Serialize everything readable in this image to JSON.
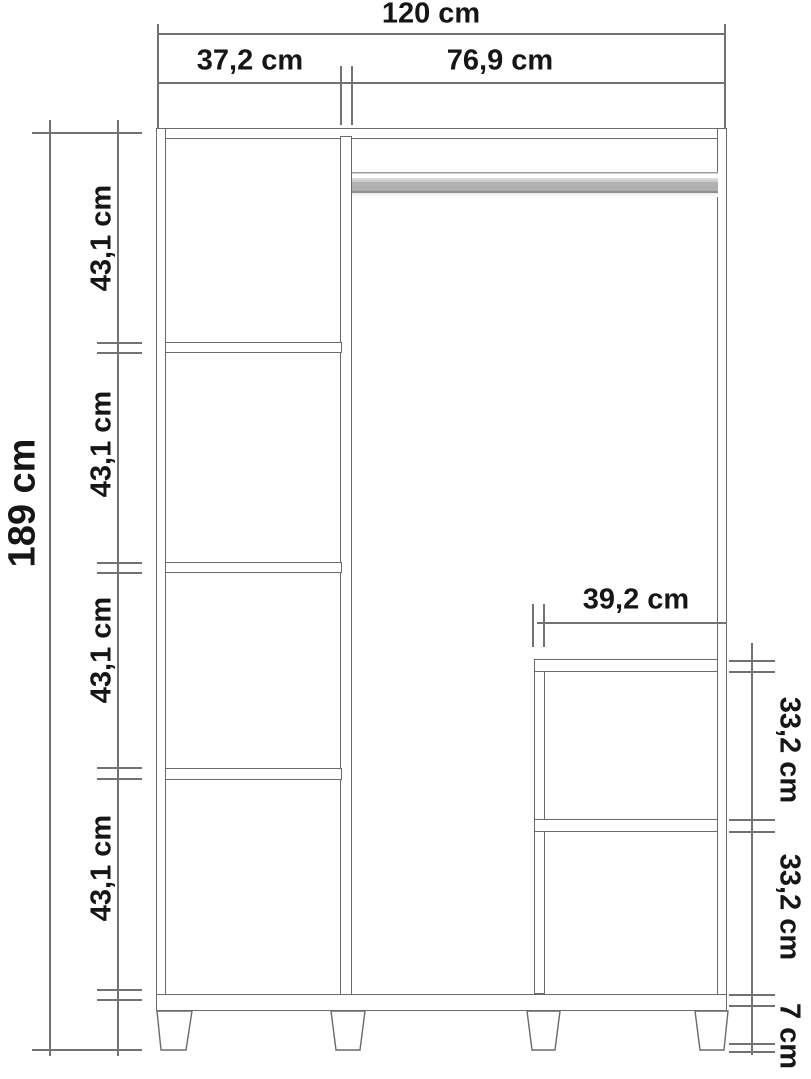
{
  "colors": {
    "background": "#ffffff",
    "structure_line": "#6a6a6a",
    "dimension_line": "#727272",
    "text": "#161616",
    "rail_gray": "#b2b2b2"
  },
  "labels": {
    "total_width": "120 cm",
    "left_section_width": "37,2 cm",
    "right_section_width": "76,9 cm",
    "total_height": "189 cm",
    "left_gap_1": "43,1 cm",
    "left_gap_2": "43,1 cm",
    "left_gap_3": "43,1 cm",
    "left_gap_4": "43,1 cm",
    "compartment_width": "39,2 cm",
    "compartment_gap_1": "33,2 cm",
    "compartment_gap_2": "33,2 cm",
    "leg_height": "7 cm"
  }
}
